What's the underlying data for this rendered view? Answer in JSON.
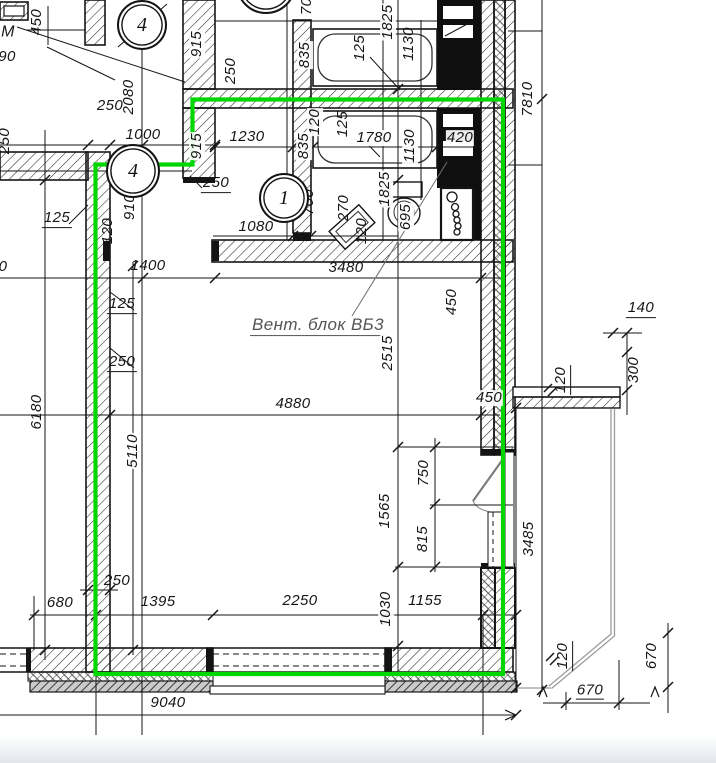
{
  "meta": {
    "title": "Фрагмент архитектурного плана",
    "kind": "architectural-floor-plan"
  },
  "colors": {
    "highlight_green": "#00d600",
    "line_black": "#161616",
    "leader_gray": "#8a8a8a",
    "balcony_gray": "#9c9c9c",
    "page_edge": "#e3e7ec"
  },
  "annotation": {
    "vent_block_label": "Вент. блок  ВБ3"
  },
  "axis_bubbles": [
    {
      "label": "4",
      "x": 142,
      "y": 25,
      "d": 46
    },
    {
      "label": "4",
      "x": 133,
      "y": 171,
      "d": 50
    },
    {
      "label": "1",
      "x": 284,
      "y": 198,
      "d": 46
    },
    {
      "label": "",
      "x": 266,
      "y": -16,
      "d": 56
    }
  ],
  "labels": [
    {
      "t": "М",
      "x": 8,
      "y": 33,
      "r": 0,
      "fs": 16
    },
    {
      "t": "90",
      "x": 7,
      "y": 57,
      "r": 0
    },
    {
      "t": "450",
      "x": 37,
      "y": 22,
      "r": -90
    },
    {
      "t": "250",
      "x": 5,
      "y": 141,
      "r": -90
    },
    {
      "t": "2080",
      "x": 129,
      "y": 97,
      "r": -90,
      "bg": 1
    },
    {
      "t": "250",
      "x": 110,
      "y": 106,
      "r": 0
    },
    {
      "t": "1000",
      "x": 143,
      "y": 135,
      "r": 0
    },
    {
      "t": "915",
      "x": 197,
      "y": 44,
      "r": -90,
      "bg": 1
    },
    {
      "t": "250",
      "x": 231,
      "y": 71,
      "r": -90
    },
    {
      "t": "915",
      "x": 197,
      "y": 146,
      "r": -90,
      "bg": 1
    },
    {
      "t": "250",
      "x": 216,
      "y": 184,
      "r": 0,
      "u": 1
    },
    {
      "t": "1230",
      "x": 247,
      "y": 137,
      "r": 0
    },
    {
      "t": "910",
      "x": 130,
      "y": 207,
      "r": -90
    },
    {
      "t": "120",
      "x": 108,
      "y": 231,
      "r": -90
    },
    {
      "t": "125",
      "x": 57,
      "y": 219,
      "r": 0,
      "u": 1
    },
    {
      "t": "1080",
      "x": 256,
      "y": 227,
      "r": 0
    },
    {
      "t": "700",
      "x": 309,
      "y": 202,
      "r": -90
    },
    {
      "t": "270",
      "x": 344,
      "y": 208,
      "r": -90
    },
    {
      "t": "120",
      "x": 362,
      "y": 231,
      "r": -90
    },
    {
      "t": "695",
      "x": 406,
      "y": 217,
      "r": -90,
      "bg": 1
    },
    {
      "t": "1825",
      "x": 385,
      "y": 189,
      "r": -90,
      "bg": 1
    },
    {
      "t": "835",
      "x": 305,
      "y": 55,
      "r": -90,
      "bg": 1
    },
    {
      "t": "125",
      "x": 360,
      "y": 48,
      "r": -90
    },
    {
      "t": "1825",
      "x": 388,
      "y": 22,
      "r": -90,
      "bg": 1
    },
    {
      "t": "1130",
      "x": 409,
      "y": 44,
      "r": -90
    },
    {
      "t": "700",
      "x": 307,
      "y": 2,
      "r": -90
    },
    {
      "t": "120",
      "x": 315,
      "y": 122,
      "r": -90,
      "bg": 1
    },
    {
      "t": "125",
      "x": 343,
      "y": 124,
      "r": -90
    },
    {
      "t": "835",
      "x": 304,
      "y": 146,
      "r": -90,
      "bg": 1
    },
    {
      "t": "1780",
      "x": 374,
      "y": 138,
      "r": 0,
      "bg": 1
    },
    {
      "t": "1130",
      "x": 410,
      "y": 146,
      "r": -90,
      "bg": 1
    },
    {
      "t": "420",
      "x": 460,
      "y": 138,
      "r": 0,
      "bg": 1
    },
    {
      "t": "7810",
      "x": 528,
      "y": 99,
      "r": -90
    },
    {
      "t": "1400",
      "x": 148,
      "y": 266,
      "r": 0
    },
    {
      "t": "3480",
      "x": 346,
      "y": 268,
      "r": 0
    },
    {
      "t": "125",
      "x": 122,
      "y": 305,
      "r": 0,
      "u": 1
    },
    {
      "t": "250",
      "x": 122,
      "y": 363,
      "r": 0,
      "u": 1
    },
    {
      "t": "Вент. блок  ВБ3",
      "x": 318,
      "y": 326,
      "r": 0,
      "u": 1,
      "fs": 17,
      "c": "#555"
    },
    {
      "t": "2515",
      "x": 388,
      "y": 353,
      "r": -90,
      "bg": 1
    },
    {
      "t": "4880",
      "x": 293,
      "y": 404,
      "r": 0
    },
    {
      "t": "6180",
      "x": 37,
      "y": 412,
      "r": -90
    },
    {
      "t": "5110",
      "x": 133,
      "y": 451,
      "r": -90,
      "bg": 1
    },
    {
      "t": "450",
      "x": 452,
      "y": 302,
      "r": -90,
      "bg": 1
    },
    {
      "t": "450",
      "x": 489,
      "y": 398,
      "r": 0,
      "bg": 1
    },
    {
      "t": "140",
      "x": 641,
      "y": 309,
      "r": 0,
      "u": 1
    },
    {
      "t": "300",
      "x": 634,
      "y": 370,
      "r": -90
    },
    {
      "t": "120",
      "x": 562,
      "y": 380,
      "r": -90,
      "u": 1
    },
    {
      "t": "750",
      "x": 424,
      "y": 473,
      "r": -90
    },
    {
      "t": "815",
      "x": 423,
      "y": 539,
      "r": -90
    },
    {
      "t": "1565",
      "x": 385,
      "y": 511,
      "r": -90,
      "bg": 1
    },
    {
      "t": "3485",
      "x": 529,
      "y": 539,
      "r": -90
    },
    {
      "t": "250",
      "x": 117,
      "y": 581,
      "r": 0
    },
    {
      "t": "680",
      "x": 60,
      "y": 603,
      "r": 0
    },
    {
      "t": "1395",
      "x": 158,
      "y": 602,
      "r": 0
    },
    {
      "t": "2250",
      "x": 300,
      "y": 601,
      "r": 0
    },
    {
      "t": "1030",
      "x": 386,
      "y": 609,
      "r": -90,
      "bg": 1
    },
    {
      "t": "1155",
      "x": 425,
      "y": 601,
      "r": 0
    },
    {
      "t": "9040",
      "x": 168,
      "y": 703,
      "r": 0
    },
    {
      "t": "670",
      "x": 590,
      "y": 691,
      "r": 0,
      "u": 1,
      "bg": 1
    },
    {
      "t": "120",
      "x": 564,
      "y": 656,
      "r": -90,
      "u": 1
    },
    {
      "t": "670",
      "x": 652,
      "y": 656,
      "r": -90
    },
    {
      "t": "0",
      "x": 3,
      "y": 267,
      "r": 0
    }
  ]
}
